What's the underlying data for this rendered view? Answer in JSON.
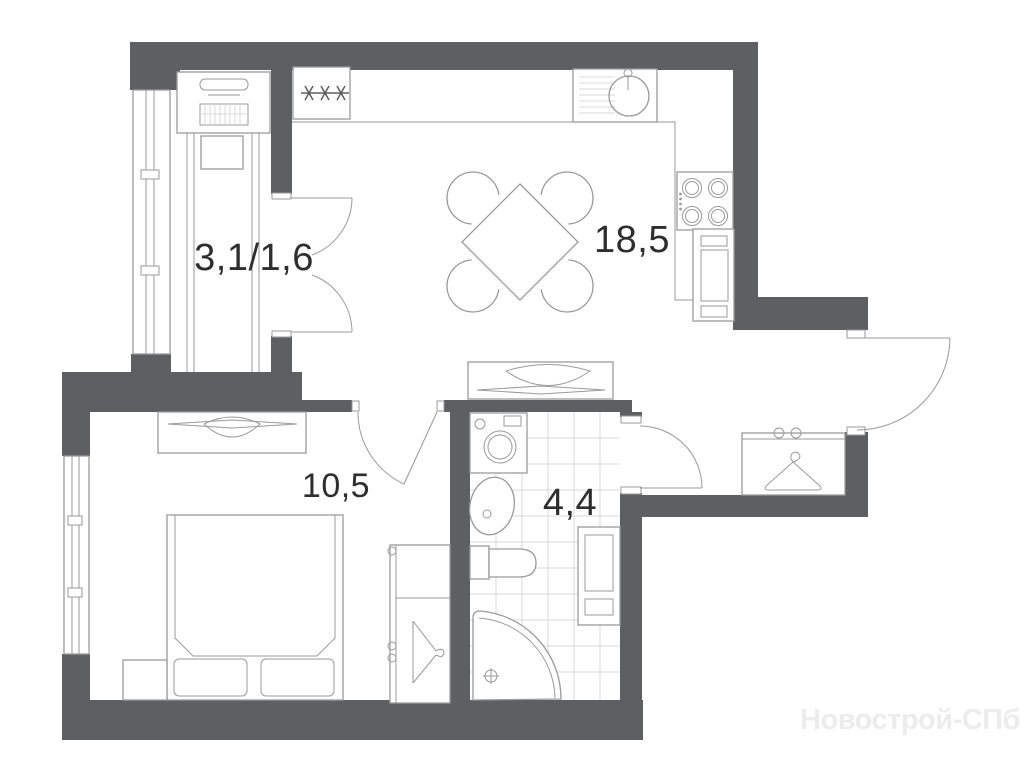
{
  "floor_plan": {
    "rooms": [
      {
        "name": "balcony-loggia",
        "area_label": "3,1/1,6"
      },
      {
        "name": "kitchen-living-room",
        "area_label": "18,5"
      },
      {
        "name": "bedroom",
        "area_label": "10,5"
      },
      {
        "name": "bathroom",
        "area_label": "4,4"
      }
    ],
    "watermark": "Новострой-СПб",
    "colors": {
      "wall": "#5e5f61",
      "line": "#9a9a9a",
      "tile": "#d9d9d9",
      "label": "#2e2e2e",
      "watermark": "#ececec",
      "bg": "#ffffff"
    }
  }
}
